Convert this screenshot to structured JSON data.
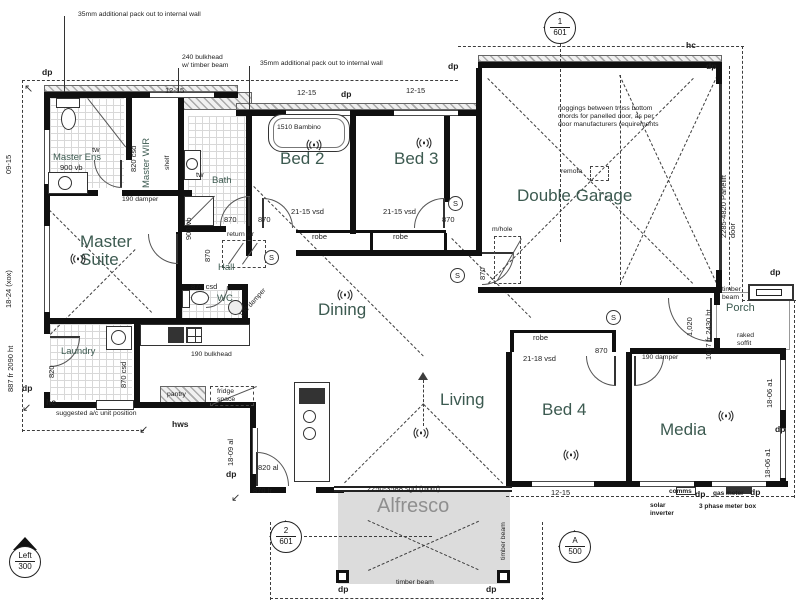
{
  "palette": {
    "wall": "#101010",
    "room_label": "#3c5a50",
    "annotation": "#1d1d1d",
    "dashed_line": "#3d3d3d",
    "alfresco_fill": "#dcdcdc",
    "tile_line": "#d8d8d8"
  },
  "texts": [
    {
      "n": "note-packout-left",
      "t": "35mm additional pack out to internal wall",
      "x": 78,
      "y": 11,
      "c": "ann"
    },
    {
      "n": "note-bulkhead-timber",
      "t": "240 bulkhead\nw/ timber beam",
      "x": 182,
      "y": 54,
      "c": "ann"
    },
    {
      "n": "note-packout-right",
      "t": "35mm additional pack out to internal wall",
      "x": 260,
      "y": 60,
      "c": "ann"
    },
    {
      "n": "note-noggings",
      "t": "noggings between truss bottom\nchords for panelled door, as per\ndoor manufacturers requirements",
      "x": 558,
      "y": 105,
      "c": "ann"
    },
    {
      "n": "note-ac-unit",
      "t": "suggested a/c unit position",
      "x": 56,
      "y": 410,
      "c": "ann"
    },
    {
      "n": "note-bulkhead-190",
      "t": "190 bulkhead",
      "x": 191,
      "y": 351,
      "c": "ann"
    },
    {
      "n": "damper-label",
      "t": "190 damper",
      "x": 122,
      "y": 196,
      "c": "ann"
    },
    {
      "n": "damper-label",
      "t": "190 damper",
      "x": 238,
      "y": 314,
      "c": "ann",
      "r": -48
    },
    {
      "n": "damper-label",
      "t": "190 damper",
      "x": 642,
      "y": 354,
      "c": "ann"
    },
    {
      "n": "remote-label",
      "t": "remote",
      "x": 561,
      "y": 168,
      "c": "ann"
    },
    {
      "n": "manhole-label",
      "t": "m/hole",
      "x": 492,
      "y": 226,
      "c": "ann"
    },
    {
      "n": "return-air-label",
      "t": "return air",
      "x": 227,
      "y": 231,
      "c": "ann"
    },
    {
      "n": "timber-beam-label",
      "t": "timber\nbeam",
      "x": 722,
      "y": 286,
      "c": "ann"
    },
    {
      "n": "raked-soffit-label",
      "t": "raked\nsoffit",
      "x": 737,
      "y": 332,
      "c": "ann"
    },
    {
      "n": "timber-beam-label",
      "t": "timber beam",
      "x": 500,
      "y": 560,
      "c": "ann",
      "r": -90
    },
    {
      "n": "timber-beam-label",
      "t": "timber beam",
      "x": 396,
      "y": 579,
      "c": "ann"
    },
    {
      "n": "shelf-label",
      "t": "shelf",
      "x": 164,
      "y": 170,
      "c": "ann",
      "r": -90
    },
    {
      "n": "fridge-space-label",
      "t": "fridge\nspace",
      "x": 217,
      "y": 388,
      "c": "ann"
    },
    {
      "n": "pantry-label",
      "t": "pantry",
      "x": 167,
      "y": 391,
      "c": "ann"
    },
    {
      "n": "hws-label",
      "t": "hws",
      "x": 172,
      "y": 419,
      "c": "bold"
    },
    {
      "n": "hc-label",
      "t": "hc",
      "x": 46,
      "y": 397,
      "c": "bold"
    },
    {
      "n": "hc-label",
      "t": "hc",
      "x": 686,
      "y": 40,
      "c": "bold"
    },
    {
      "n": "comms-label",
      "t": "comms",
      "x": 669,
      "y": 488,
      "c": "bold7"
    },
    {
      "n": "gas-meter-label",
      "t": "gas meter",
      "x": 713,
      "y": 490,
      "c": "bold7"
    },
    {
      "n": "meter-box-label",
      "t": "3 phase meter box",
      "x": 699,
      "y": 503,
      "c": "bold7"
    },
    {
      "n": "solar-inverter-label",
      "t": "solar\ninverter",
      "x": 650,
      "y": 502,
      "c": "bold7"
    },
    {
      "n": "dp-marker",
      "t": "dp",
      "x": 42,
      "y": 67,
      "c": "bold"
    },
    {
      "n": "dp-marker",
      "t": "dp",
      "x": 341,
      "y": 89,
      "c": "bold"
    },
    {
      "n": "dp-marker",
      "t": "dp",
      "x": 448,
      "y": 61,
      "c": "bold"
    },
    {
      "n": "dp-marker",
      "t": "dp",
      "x": 706,
      "y": 61,
      "c": "bold"
    },
    {
      "n": "dp-marker",
      "t": "dp",
      "x": 770,
      "y": 267,
      "c": "bold"
    },
    {
      "n": "dp-marker",
      "t": "dp",
      "x": 775,
      "y": 424,
      "c": "bold"
    },
    {
      "n": "dp-marker",
      "t": "dp",
      "x": 22,
      "y": 383,
      "c": "bold"
    },
    {
      "n": "dp-marker",
      "t": "dp",
      "x": 226,
      "y": 469,
      "c": "bold"
    },
    {
      "n": "dp-marker",
      "t": "dp",
      "x": 338,
      "y": 584,
      "c": "bold"
    },
    {
      "n": "dp-marker",
      "t": "dp",
      "x": 486,
      "y": 584,
      "c": "bold"
    },
    {
      "n": "dp-marker",
      "t": "dp",
      "x": 695,
      "y": 489,
      "c": "bold"
    },
    {
      "n": "dp-marker",
      "t": "dp",
      "x": 750,
      "y": 487,
      "c": "bold"
    },
    {
      "n": "window-code",
      "t": "12-15",
      "x": 165,
      "y": 87,
      "c": "code"
    },
    {
      "n": "window-code",
      "t": "12-15",
      "x": 297,
      "y": 89,
      "c": "code"
    },
    {
      "n": "window-code",
      "t": "12-15",
      "x": 406,
      "y": 87,
      "c": "code"
    },
    {
      "n": "window-code",
      "t": "09-15",
      "x": 5,
      "y": 174,
      "c": "code",
      "r": -90
    },
    {
      "n": "window-code",
      "t": "18-24 (xox)",
      "x": 5,
      "y": 308,
      "c": "code",
      "r": -90
    },
    {
      "n": "door-code",
      "t": "887 fr 2090 ht",
      "x": 7,
      "y": 392,
      "c": "code",
      "r": -90
    },
    {
      "n": "door-code",
      "t": "820",
      "x": 48,
      "y": 378,
      "c": "code",
      "r": -90
    },
    {
      "n": "door-code",
      "t": "870 csd",
      "x": 120,
      "y": 388,
      "c": "code",
      "r": -90
    },
    {
      "n": "door-code",
      "t": "820 csd",
      "x": 130,
      "y": 172,
      "c": "code",
      "r": -90
    },
    {
      "n": "fixture-code",
      "t": "900 vb",
      "x": 60,
      "y": 164,
      "c": "code"
    },
    {
      "n": "fixture-code",
      "t": "tw",
      "x": 92,
      "y": 146,
      "c": "code"
    },
    {
      "n": "fixture-code",
      "t": "tw",
      "x": 196,
      "y": 171,
      "c": "code"
    },
    {
      "n": "fixture-code",
      "t": "900 vb",
      "x": 185,
      "y": 240,
      "c": "code",
      "r": -90
    },
    {
      "n": "bath-model",
      "t": "1510 Bambino",
      "x": 277,
      "y": 124,
      "c": "ann"
    },
    {
      "n": "door-code",
      "t": "870",
      "x": 224,
      "y": 216,
      "c": "code"
    },
    {
      "n": "door-code",
      "t": "870",
      "x": 258,
      "y": 216,
      "c": "code"
    },
    {
      "n": "door-code",
      "t": "870",
      "x": 442,
      "y": 216,
      "c": "code"
    },
    {
      "n": "door-code",
      "t": "870",
      "x": 204,
      "y": 262,
      "c": "code",
      "r": -90
    },
    {
      "n": "door-code",
      "t": "870",
      "x": 479,
      "y": 280,
      "c": "code",
      "r": -90
    },
    {
      "n": "door-code",
      "t": "870",
      "x": 595,
      "y": 347,
      "c": "code"
    },
    {
      "n": "window-code",
      "t": "21-15 vsd",
      "x": 291,
      "y": 208,
      "c": "code"
    },
    {
      "n": "window-code",
      "t": "21-15 vsd",
      "x": 383,
      "y": 208,
      "c": "code"
    },
    {
      "n": "robe-label",
      "t": "robe",
      "x": 312,
      "y": 233,
      "c": "code"
    },
    {
      "n": "robe-label",
      "t": "robe",
      "x": 393,
      "y": 233,
      "c": "code"
    },
    {
      "n": "robe-label",
      "t": "robe",
      "x": 533,
      "y": 334,
      "c": "code"
    },
    {
      "n": "window-code",
      "t": "21-18 vsd",
      "x": 523,
      "y": 355,
      "c": "code"
    },
    {
      "n": "door-code",
      "t": "870 csd",
      "x": 191,
      "y": 283,
      "c": "code"
    },
    {
      "n": "window-code",
      "t": "12-15",
      "x": 551,
      "y": 489,
      "c": "code"
    },
    {
      "n": "window-code",
      "t": "18-09 al",
      "x": 227,
      "y": 466,
      "c": "code",
      "r": -90
    },
    {
      "n": "window-code",
      "t": "18-06 a1",
      "x": 766,
      "y": 408,
      "c": "code",
      "r": -90
    },
    {
      "n": "window-code",
      "t": "18-06 a1",
      "x": 764,
      "y": 478,
      "c": "code",
      "r": -90
    },
    {
      "n": "garage-door-code",
      "t": "2285-4820 Panelift door",
      "x": 720,
      "y": 238,
      "c": "code",
      "r": -90
    },
    {
      "n": "door-code",
      "t": "1087 fr 2430 ht",
      "x": 705,
      "y": 360,
      "c": "code",
      "r": -90
    },
    {
      "n": "door-code",
      "t": "1,020",
      "x": 686,
      "y": 336,
      "c": "code",
      "r": -90
    },
    {
      "n": "sliding-door-code",
      "t": "2250-3588 sgd (oxxo)",
      "x": 367,
      "y": 485,
      "c": "code"
    },
    {
      "n": "door-code",
      "t": "870 fr",
      "x": 253,
      "y": 487,
      "c": "code"
    },
    {
      "n": "door-code",
      "t": "820 al",
      "x": 258,
      "y": 464,
      "c": "code"
    },
    {
      "n": "room-label-master-suite",
      "t": "Master\nSuite",
      "x": 80,
      "y": 233,
      "c": "room"
    },
    {
      "n": "room-label-bed2",
      "t": "Bed 2",
      "x": 280,
      "y": 150,
      "c": "room"
    },
    {
      "n": "room-label-bed3",
      "t": "Bed 3",
      "x": 394,
      "y": 150,
      "c": "room"
    },
    {
      "n": "room-label-garage",
      "t": "Double Garage",
      "x": 517,
      "y": 187,
      "c": "room"
    },
    {
      "n": "room-label-dining",
      "t": "Dining",
      "x": 318,
      "y": 301,
      "c": "room"
    },
    {
      "n": "room-label-living",
      "t": "Living",
      "x": 440,
      "y": 391,
      "c": "room"
    },
    {
      "n": "room-label-bed4",
      "t": "Bed 4",
      "x": 542,
      "y": 401,
      "c": "room"
    },
    {
      "n": "room-label-media",
      "t": "Media",
      "x": 660,
      "y": 421,
      "c": "room"
    },
    {
      "n": "room-label-alfresco",
      "t": "Alfresco",
      "x": 377,
      "y": 495,
      "c": "room-alf"
    },
    {
      "n": "room-label-porch",
      "t": "Porch",
      "x": 726,
      "y": 302,
      "c": "room-md"
    },
    {
      "n": "room-label-hall",
      "t": "Hall",
      "x": 218,
      "y": 262,
      "c": "room-sm"
    },
    {
      "n": "room-label-wc",
      "t": "WC",
      "x": 217,
      "y": 293,
      "c": "room-sm"
    },
    {
      "n": "room-label-bath",
      "t": "Bath",
      "x": 212,
      "y": 175,
      "c": "room-sm"
    },
    {
      "n": "room-label-master-ens",
      "t": "Master Ens",
      "x": 53,
      "y": 152,
      "c": "room-sm"
    },
    {
      "n": "room-label-master-wir",
      "t": "Master WIR",
      "x": 141,
      "y": 188,
      "c": "room-sm",
      "r": -90
    },
    {
      "n": "room-label-laundry",
      "t": "Laundry",
      "x": 61,
      "y": 346,
      "c": "room-sm"
    },
    {
      "n": "eave-arrow",
      "t": "↖",
      "x": 24,
      "y": 83,
      "c": "arrow"
    },
    {
      "n": "eave-arrow",
      "t": "↙",
      "x": 22,
      "y": 402,
      "c": "arrow"
    },
    {
      "n": "eave-arrow",
      "t": "↙",
      "x": 139,
      "y": 424,
      "c": "arrow"
    },
    {
      "n": "eave-arrow",
      "t": "↙",
      "x": 231,
      "y": 492,
      "c": "arrow"
    }
  ],
  "markers": [
    {
      "top": "1",
      "bottom": "601",
      "x": 560,
      "y": 28,
      "variant": "diamond-outline"
    },
    {
      "top": "2",
      "bottom": "601",
      "x": 286,
      "y": 537,
      "variant": "diamond-outline"
    },
    {
      "top": "A",
      "bottom": "500",
      "x": 575,
      "y": 547,
      "variant": "diamond-fill"
    },
    {
      "top": "Left",
      "bottom": "300",
      "x": 25,
      "y": 562,
      "variant": "tri-top"
    }
  ],
  "fans": [
    {
      "x": 70,
      "y": 252
    },
    {
      "x": 306,
      "y": 138
    },
    {
      "x": 416,
      "y": 136
    },
    {
      "x": 337,
      "y": 288
    },
    {
      "x": 413,
      "y": 426
    },
    {
      "x": 563,
      "y": 448
    },
    {
      "x": 718,
      "y": 409
    }
  ],
  "smoke_detectors": [
    {
      "x": 264,
      "y": 250
    },
    {
      "x": 448,
      "y": 196
    },
    {
      "x": 450,
      "y": 268
    },
    {
      "x": 606,
      "y": 310
    }
  ]
}
